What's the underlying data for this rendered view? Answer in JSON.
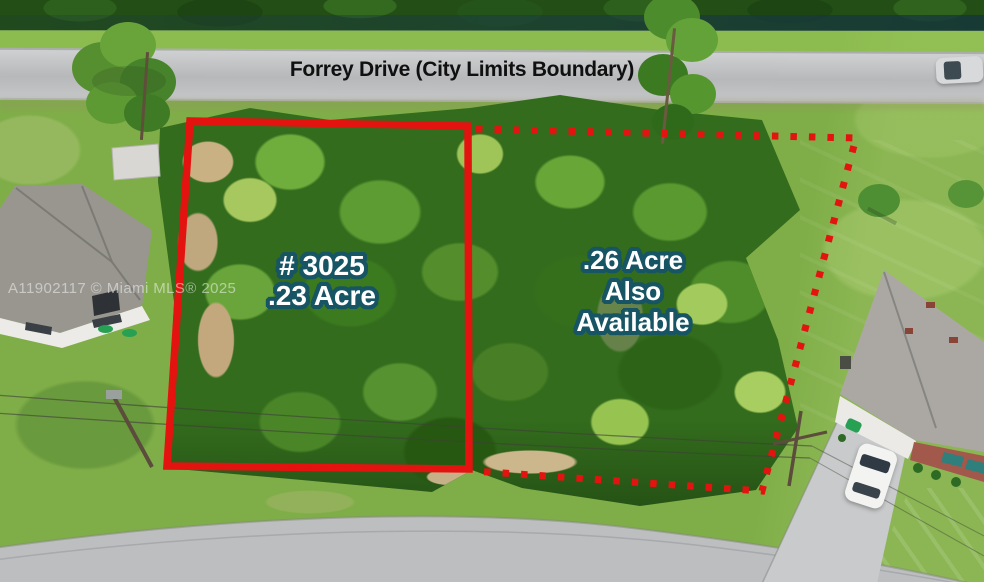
{
  "photo": {
    "road_label": "Forrey Drive (City Limits Boundary)",
    "lot_primary": {
      "number": "# 3025",
      "size": ".23 Acre"
    },
    "lot_secondary": {
      "size": ".26 Acre",
      "line2": "Also",
      "line3": "Available"
    },
    "watermark": "A11902117 © Miami MLS® 2025"
  },
  "colors": {
    "boundary_red": "#e31310",
    "label_fill": "#ffffff",
    "label_outline": "#175564",
    "road_label_color": "#101010",
    "watermark_color": "#f2f2f2"
  }
}
